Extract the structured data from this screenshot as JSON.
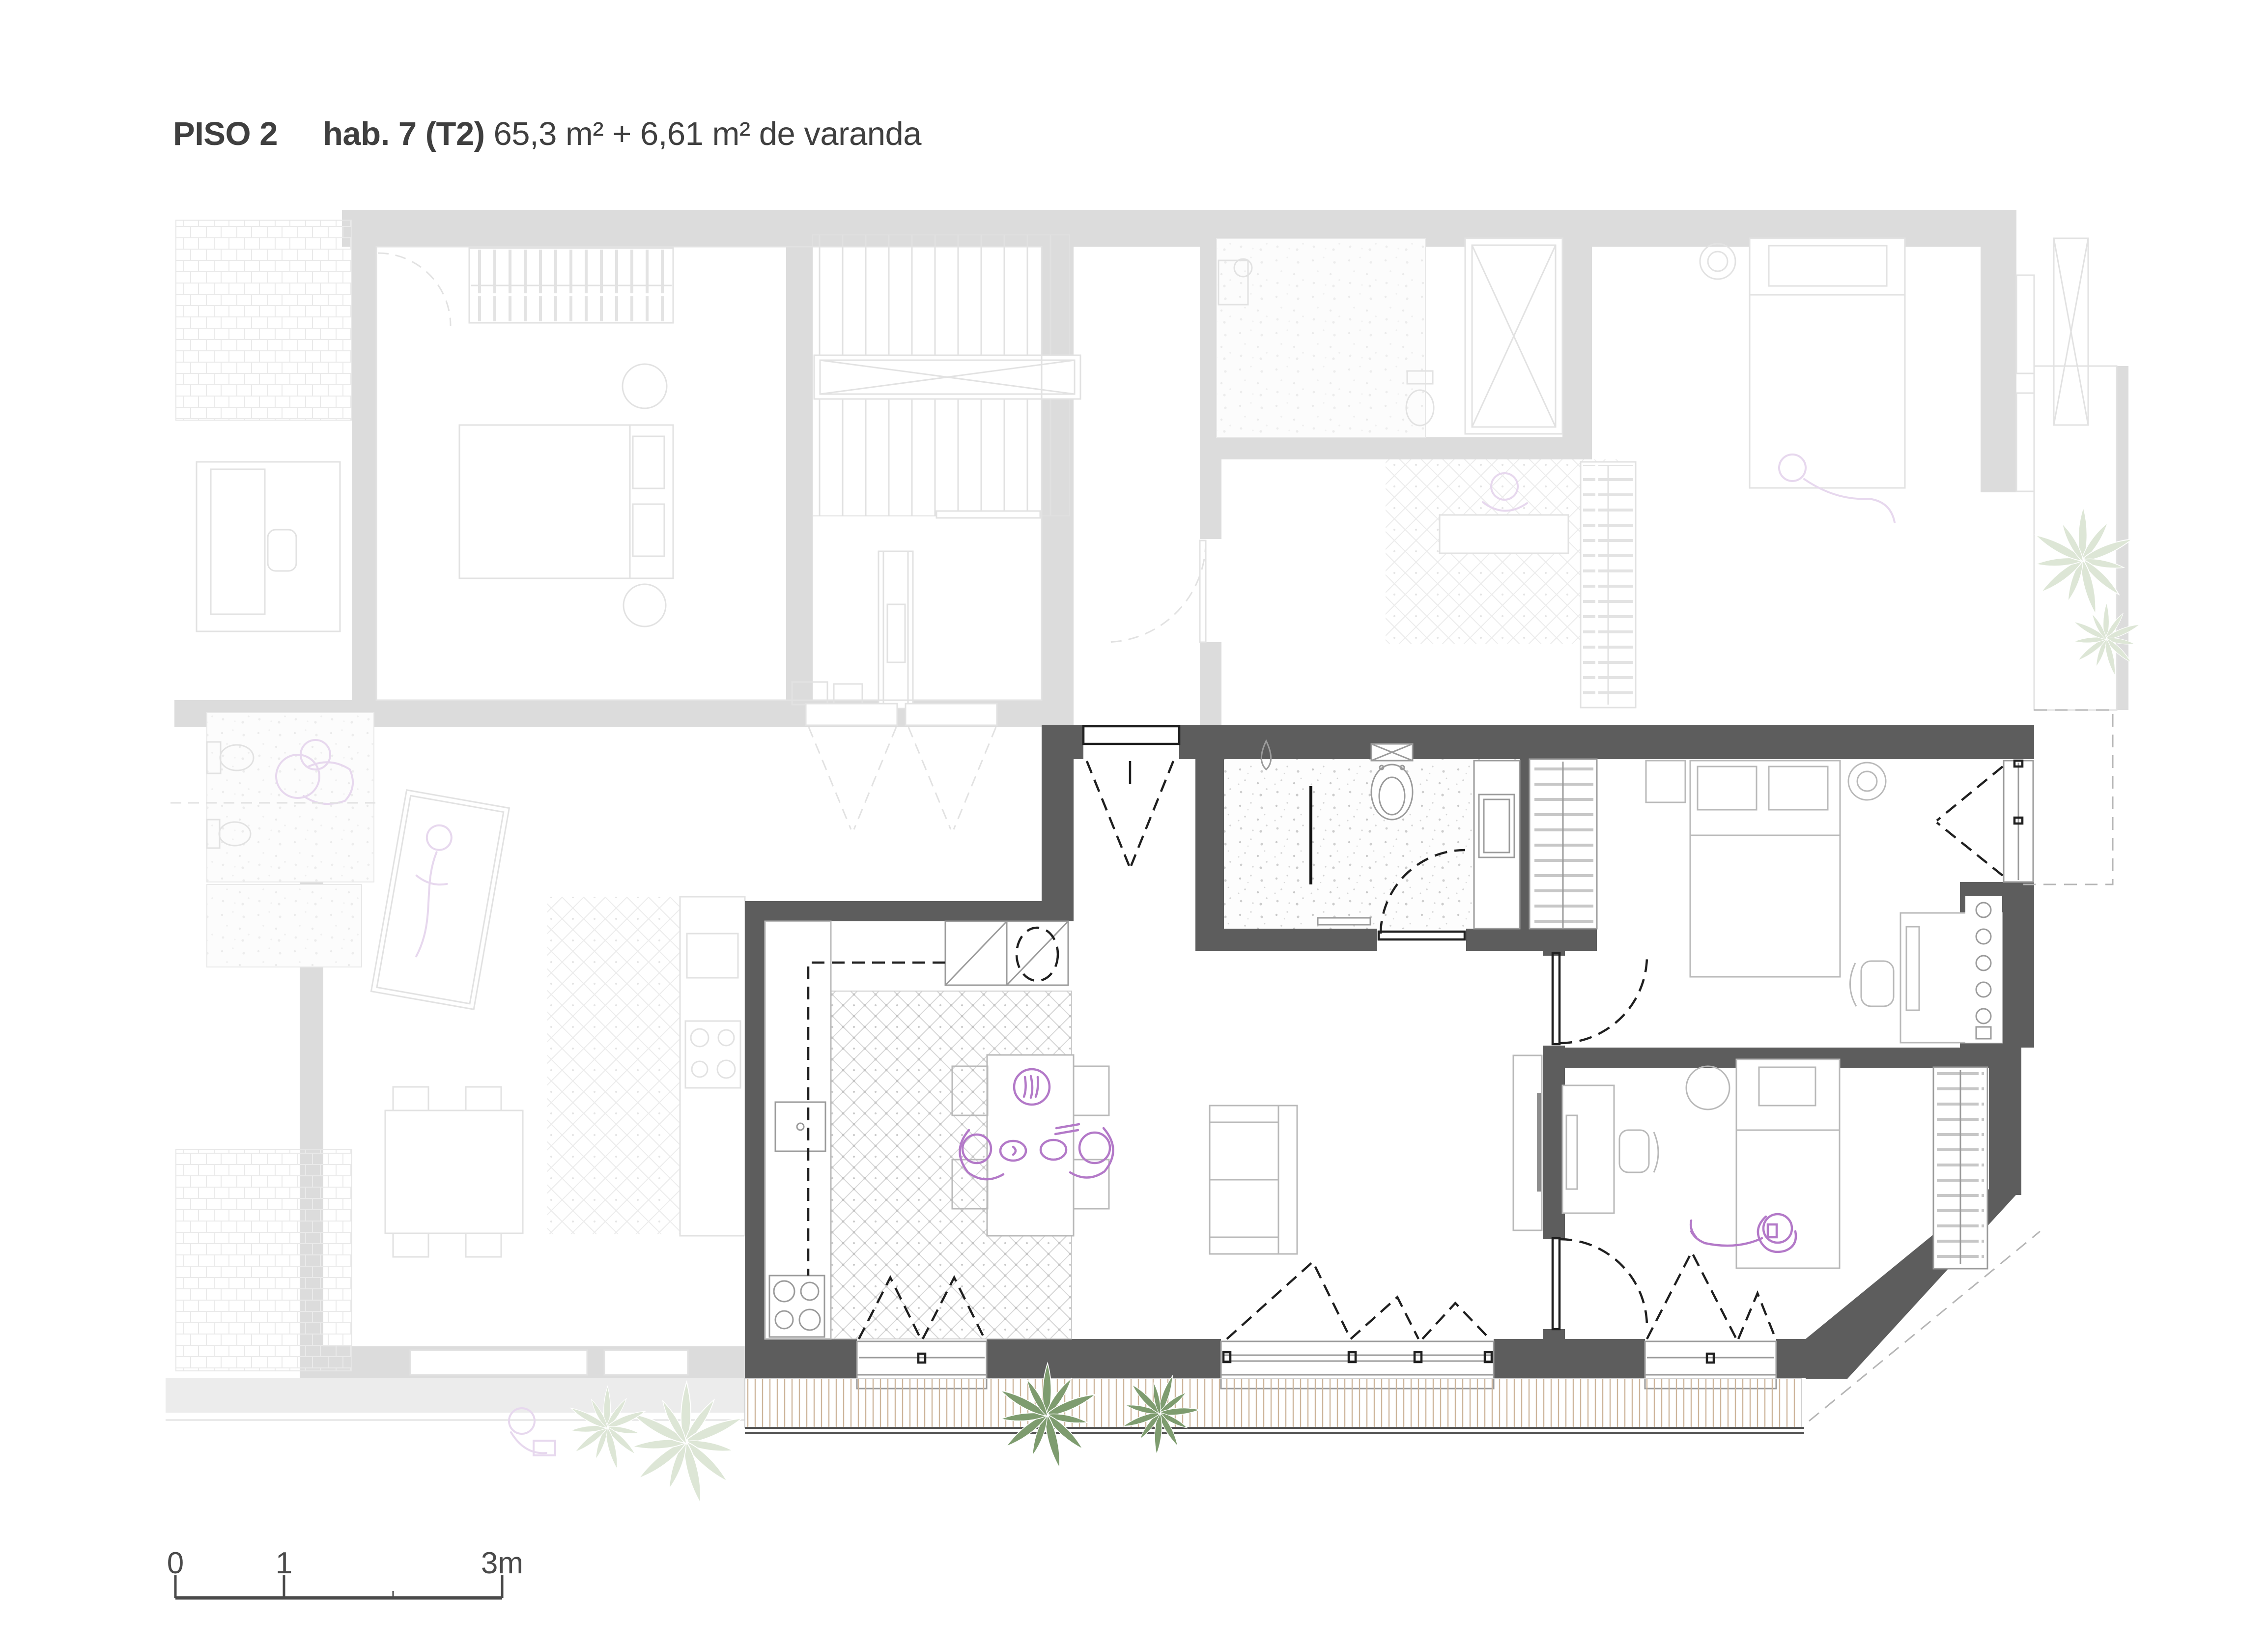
{
  "title": {
    "floor_label": "PISO 2",
    "unit_label": "hab. 7 (T2)",
    "area_label": "65,3 m² + 6,61 m² de varanda"
  },
  "scale_bar": {
    "tick_labels": [
      "0",
      "1",
      "3m"
    ]
  },
  "colors": {
    "highlight-wall": "#5d5d5d",
    "faded-wall": "#dcdcdc",
    "line-dark": "#1f1f1f",
    "line-mid": "#9b9b9b",
    "line-soft": "#b9b9b9",
    "line-faded": "#e2e2e2",
    "accent-purple": "#b379c8",
    "faded-purple": "#e7d8ee",
    "plant-green": "#7e9c6f",
    "plant-faded": "#dde6d6",
    "deck-stripe": "#cdb59b",
    "text": "#3f3f3f",
    "scalebar": "#4a4a4a"
  }
}
